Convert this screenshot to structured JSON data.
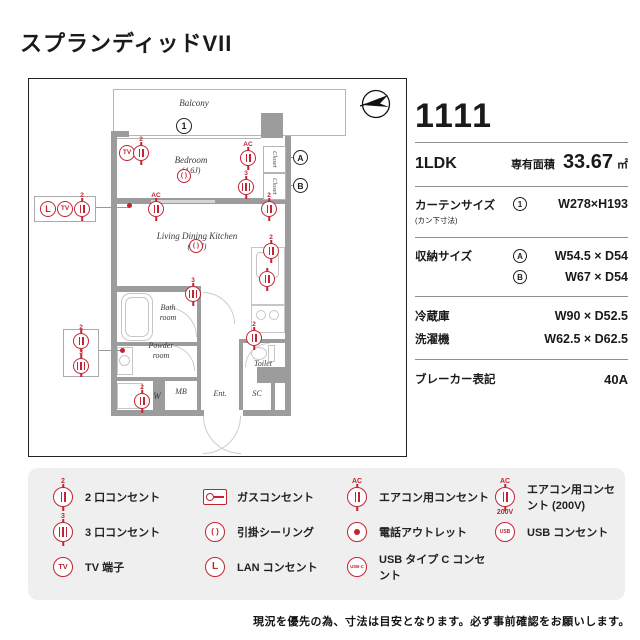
{
  "title": "スプランディッドVII",
  "colors": {
    "accent": "#c32433",
    "wall": "#9c9c9c"
  },
  "icons": {
    "two": "2",
    "three": "3",
    "tv": "TV",
    "lan": "L",
    "ac": "AC",
    "v200": "200V",
    "usb": "USB",
    "usbc": "USB-C"
  },
  "plan": {
    "balcony": "Balcony",
    "bedroom": "Bedroom",
    "bedroom_size": "(4.6J)",
    "ldk": "Living Dining Kitchen",
    "ldk_size": "(8.8J)",
    "bath_1": "Bath",
    "bath_2": "room",
    "powder_1": "Powder",
    "powder_2": "room",
    "toilet": "Toilet",
    "mb": "MB",
    "ent": "Ent.",
    "sc": "SC",
    "w": "W",
    "closet": "Closet",
    "mark_1": "1",
    "mark_a": "A",
    "mark_b": "B"
  },
  "info": {
    "room_no": "1111",
    "layout": "1LDK",
    "area_label": "専有面積",
    "area_value": "33.67",
    "area_unit": "㎡",
    "curtain_label": "カーテンサイズ",
    "curtain_sub": "(カン下寸法)",
    "curtain_mark": "1",
    "curtain_value": "W278×H193",
    "storage_label": "収納サイズ",
    "storage_a_mark": "A",
    "storage_a_value": "W54.5 × D54",
    "storage_b_mark": "B",
    "storage_b_value": "W67 × D54",
    "fridge_label": "冷蔵庫",
    "fridge_value": "W90 × D52.5",
    "washer_label": "洗濯機",
    "washer_value": "W62.5 × D62.5",
    "breaker_label": "ブレーカー表記",
    "breaker_value": "40A"
  },
  "legend": {
    "items": [
      {
        "label": "2 口コンセント"
      },
      {
        "label": "3 口コンセント"
      },
      {
        "label": "TV 端子"
      },
      {
        "label": "ガスコンセント"
      },
      {
        "label": "引掛シーリング"
      },
      {
        "label": "LAN コンセント"
      },
      {
        "label": "エアコン用コンセント"
      },
      {
        "label": "電話アウトレット"
      },
      {
        "label": "USB タイプ C コンセント"
      },
      {
        "label": "エアコン用コンセント (200V)"
      },
      {
        "label": "USB コンセント"
      }
    ]
  },
  "note": "現況を優先の為、寸法は目安となります。必ず事前確認をお願いします。"
}
